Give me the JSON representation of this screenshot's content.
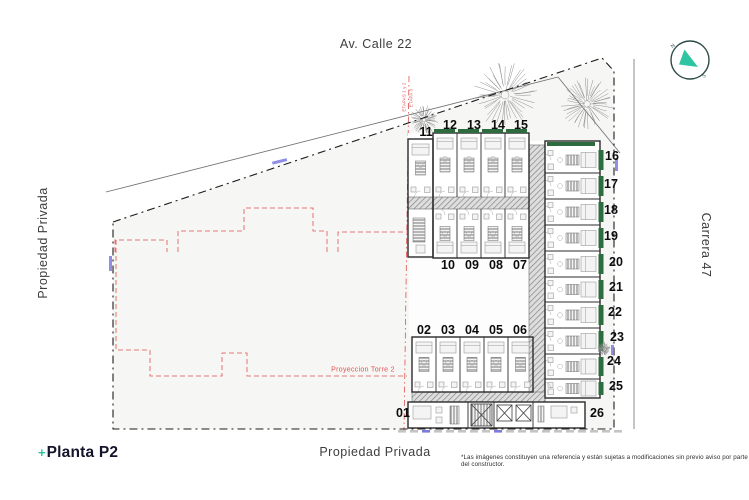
{
  "streets": {
    "top": "Av. Calle 22",
    "right": "Carrera 47",
    "left": "Propiedad Privada",
    "bottom": "Propiedad Privada"
  },
  "legend": {
    "prefix": "+",
    "title": "Planta P2"
  },
  "disclaimer": "*Las imágenes constituyen una referencia y están sujetas a modificaciones sin previo aviso por parte del constructor.",
  "annotations": {
    "projection": "Proyeccion Torre 2",
    "phase_left": "ETAPAS 1 y 2",
    "phase_right": "ETAPA 3"
  },
  "compass": {
    "north": "N",
    "south": "S"
  },
  "plan": {
    "unit_numbers": [
      "01",
      "02",
      "03",
      "04",
      "05",
      "06",
      "07",
      "08",
      "09",
      "10",
      "11",
      "12",
      "13",
      "14",
      "15",
      "16",
      "17",
      "18",
      "19",
      "20",
      "21",
      "22",
      "23",
      "24",
      "25",
      "26"
    ]
  },
  "colors": {
    "teal": "#2fc5a3",
    "red": "#e0504f",
    "green": "#2e6b3e",
    "blue": "#7b7be0",
    "ink": "#1c1c1c"
  }
}
